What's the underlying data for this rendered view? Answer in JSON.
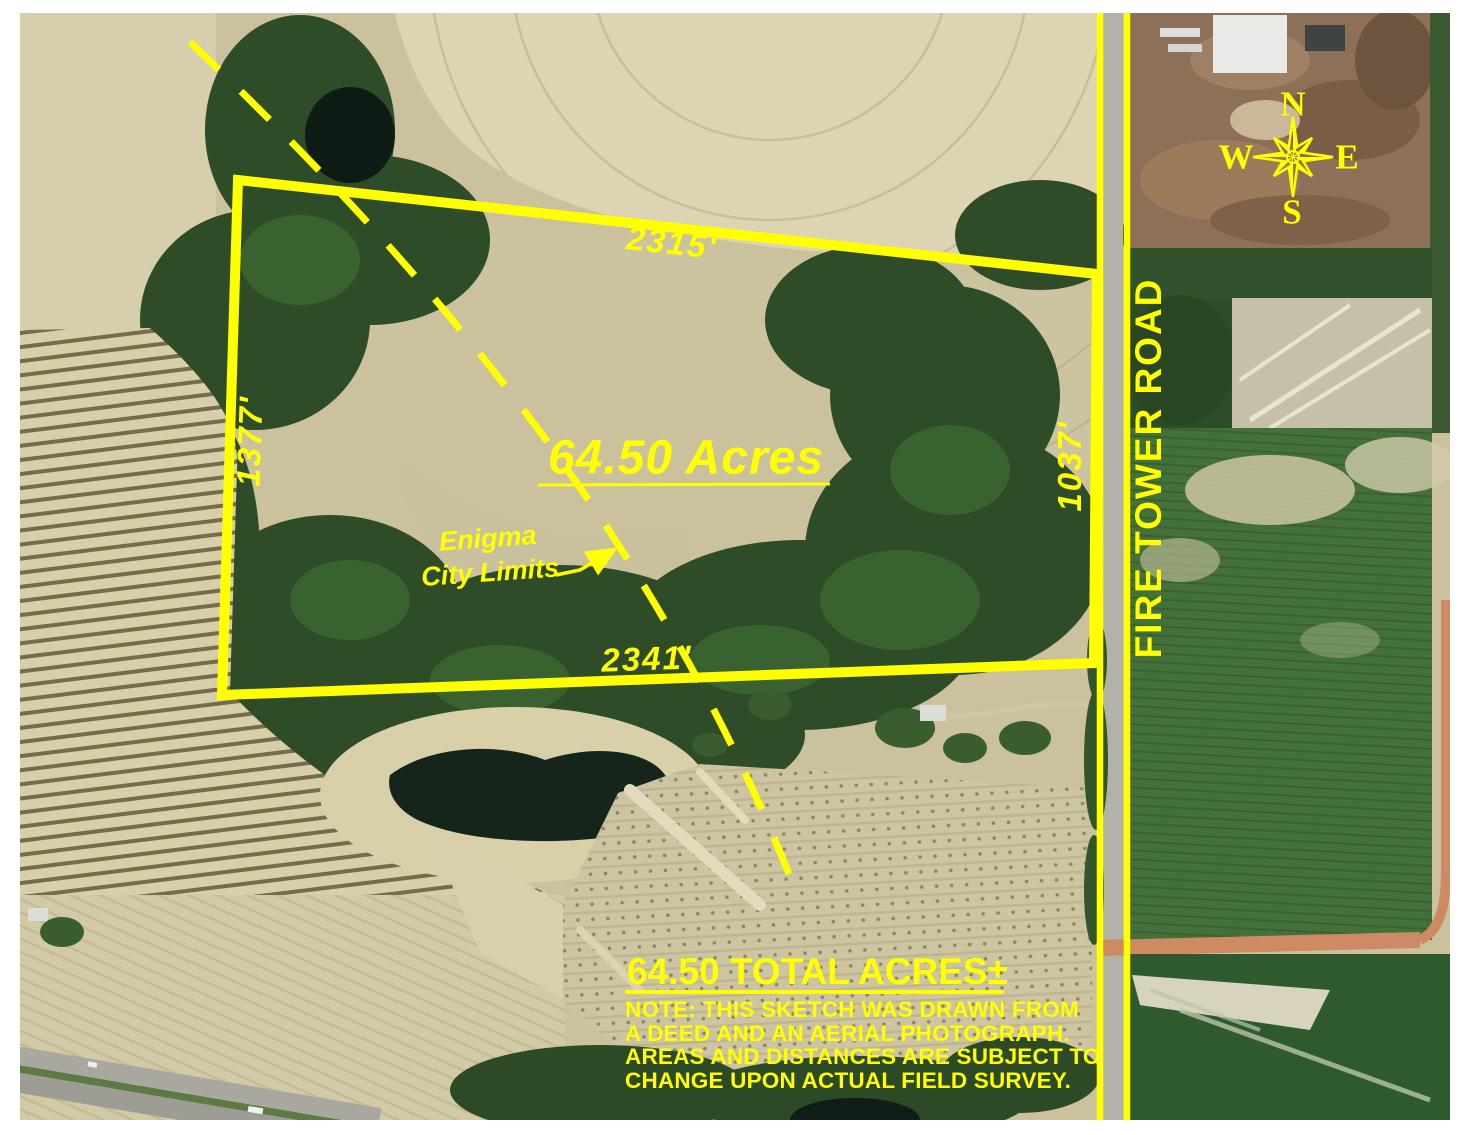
{
  "colors": {
    "annotation": "#FFFF00"
  },
  "parcel": {
    "acreage_label": "64.50 Acres",
    "dimensions": {
      "top": "2315'",
      "left": "1377'",
      "right": "1037'",
      "bottom": "2341'"
    }
  },
  "city_limits": {
    "line1": "Enigma",
    "line2": "City Limits"
  },
  "road_label": "FIRE TOWER ROAD",
  "compass": {
    "north": "N",
    "east": "E",
    "south": "S",
    "west": "W"
  },
  "footer": {
    "total_acres": "64.50 TOTAL ACRES±",
    "note_lines": [
      "NOTE: THIS SKETCH WAS DRAWN FROM",
      "A DEED AND AN AERIAL PHOTOGRAPH.",
      "AREAS AND DISTANCES ARE SUBJECT TO",
      "CHANGE UPON ACTUAL FIELD SURVEY."
    ]
  }
}
